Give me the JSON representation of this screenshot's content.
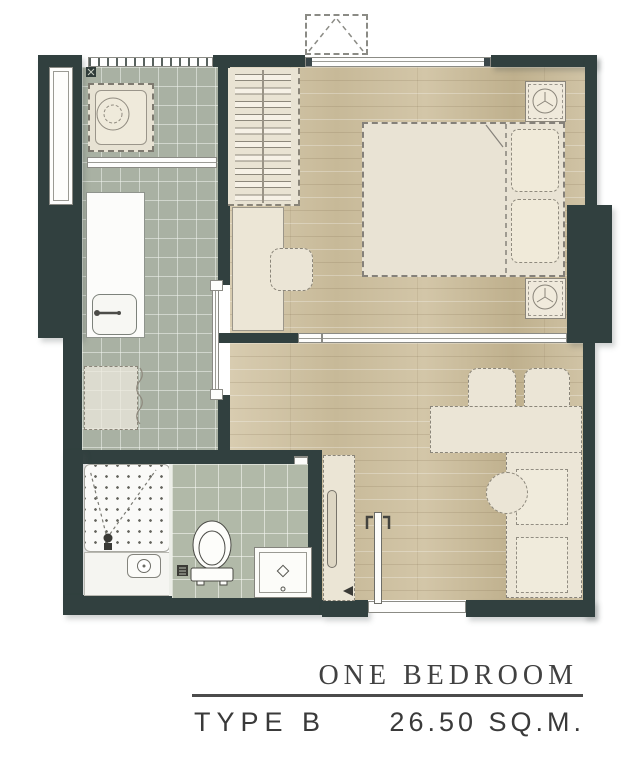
{
  "footer": {
    "title": "ONE BEDROOM",
    "type_label": "TYPE B",
    "area_label": "26.50 SQ.M."
  },
  "palette": {
    "wall": "#31403f",
    "tile_floor": "#a9b1a3",
    "bath_tile": "#b1b9a8",
    "wood_floor": "#cdbfa0",
    "furniture_fill": "#ebe5d6",
    "text": "#3a3a3a"
  },
  "plan": {
    "rooms": [
      "laundry",
      "kitchen",
      "bedroom",
      "living-dining",
      "bathroom",
      "entry"
    ],
    "furniture_icons": [
      "washing-machine",
      "kitchen-counter",
      "sink",
      "refrigerator",
      "wardrobe-hangers",
      "desk",
      "stool",
      "double-bed",
      "pillow",
      "nightstand-lamp",
      "air-conditioner-outdoor-unit",
      "dining-table",
      "dining-chair",
      "sofa",
      "coffee-table",
      "tv-console",
      "shower",
      "toilet",
      "vanity-basin",
      "entry-door",
      "sliding-door",
      "window"
    ]
  }
}
